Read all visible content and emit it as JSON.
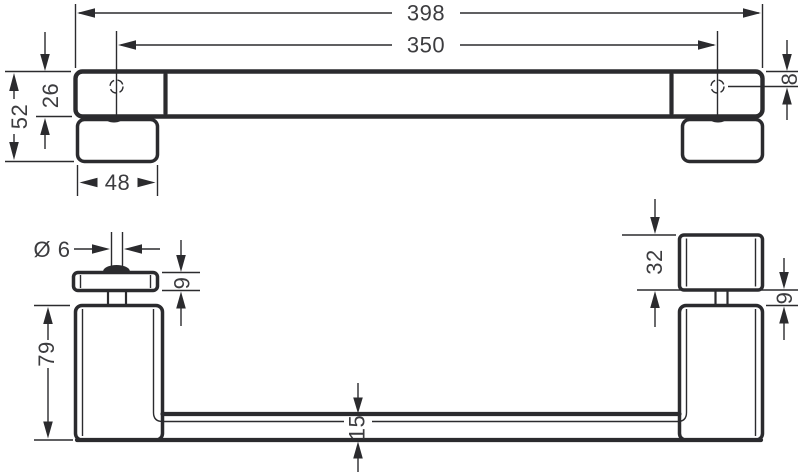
{
  "page": {
    "background": "#ffffff"
  },
  "drawing": {
    "colors": {
      "line": "#2b2b2e",
      "text": "#3c3c3f",
      "background": "#ffffff"
    },
    "views": {
      "front": {
        "dimensions": {
          "overall_width": "398",
          "hole_spacing": "350",
          "total_height": "52",
          "bar_height": "26",
          "plate_width": "48",
          "hole_offset": "8"
        }
      },
      "side": {
        "dimensions": {
          "screw_diameter": "Ø 6",
          "flange_thickness": "9",
          "leg_height": "79",
          "bar_thickness": "15",
          "clamp_height": "32",
          "neck_height": "9"
        }
      }
    }
  }
}
